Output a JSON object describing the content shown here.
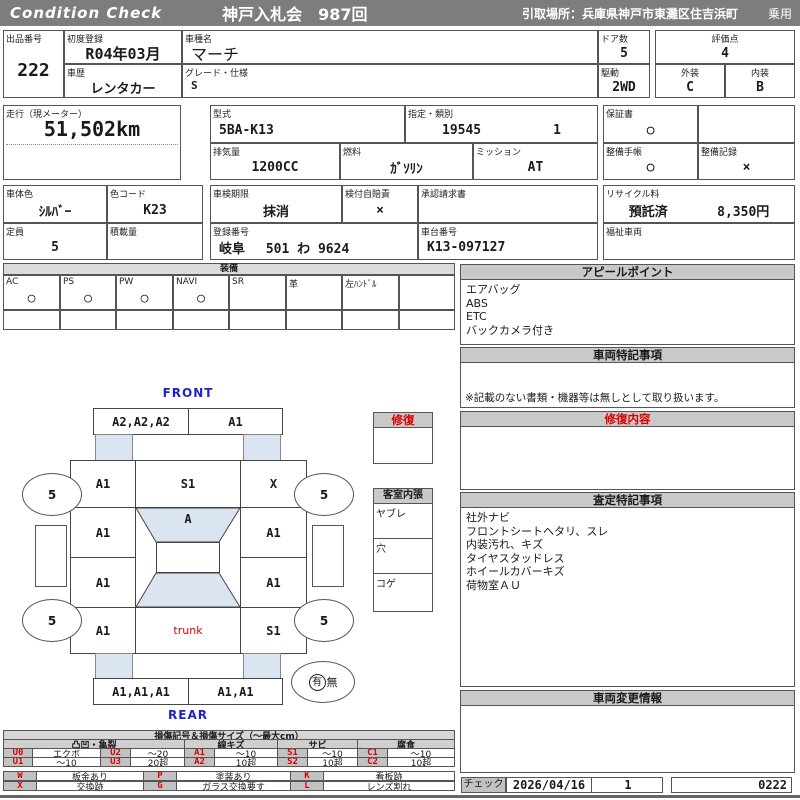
{
  "header": {
    "brand": "Condition  Check",
    "auction": "神戸入札会　987回",
    "pickup": "引取場所：兵庫県神戸市東灘区住吉浜町",
    "vehicle_type": "乗用"
  },
  "info": {
    "lot_label": "出品番号",
    "lot": "222",
    "first_reg_label": "初度登録",
    "first_reg": "R04年03月",
    "history_label": "車歴",
    "history": "レンタカー",
    "model_label": "車種名",
    "model": "マーチ",
    "grade_label": "グレード・仕様",
    "grade": "S",
    "doors_label": "ドア数",
    "doors": "5",
    "drive_label": "駆動",
    "drive": "2WD",
    "score_label": "評価点",
    "score": "4",
    "exterior_label": "外装",
    "exterior": "C",
    "interior_label": "内装",
    "interior": "B",
    "mileage_label": "走行（現メーター）",
    "mileage": "51,502km",
    "model_code_label": "型式",
    "model_code": "5BA-K13",
    "class_label": "指定・類別",
    "class_no": "19545",
    "class_no2": "1",
    "displacement_label": "排気量",
    "displacement": "1200CC",
    "fuel_label": "燃料",
    "fuel": "ｶﾞｿﾘﾝ",
    "mission_label": "ミッション",
    "mission": "AT",
    "warranty_label": "保証書",
    "warranty": "○",
    "maintenance_book_label": "整備手帳",
    "maintenance_book": "○",
    "maintenance_record_label": "整備記録",
    "maintenance_record": "×",
    "color_label": "車体色",
    "color": "ｼﾙﾊﾞｰ",
    "color_code_label": "色コード",
    "color_code": "K23",
    "capacity_label": "定員",
    "capacity": "5",
    "load_label": "積載量",
    "load": "",
    "inspection_label": "車検期限",
    "inspection": "抹消",
    "insurance_label": "検付自賠責",
    "insurance": "×",
    "approval_label": "承認請求書",
    "approval": "",
    "reg_no_label": "登録番号",
    "reg_no": "岐阜　 501 わ 9624",
    "chassis_label": "車台番号",
    "chassis": "K13-097127",
    "recycle_label": "リサイクル料",
    "recycle_status": "預託済",
    "recycle_fee": "8,350円",
    "welfare_label": "福祉車両",
    "welfare": ""
  },
  "equipment": {
    "title": "装備",
    "items": [
      {
        "label": "AC",
        "value": "○"
      },
      {
        "label": "PS",
        "value": "○"
      },
      {
        "label": "PW",
        "value": "○"
      },
      {
        "label": "NAVI",
        "value": "○"
      },
      {
        "label": "SR",
        "value": ""
      },
      {
        "label": "革",
        "value": ""
      },
      {
        "label": "左ﾊﾝﾄﾞﾙ",
        "value": ""
      },
      {
        "label": "",
        "value": ""
      }
    ]
  },
  "appeal": {
    "title": "アピールポイント",
    "lines": [
      "エアバッグ",
      "ABS",
      "ETC",
      "バックカメラ付き"
    ]
  },
  "vehicle_notes": {
    "title": "車両特記事項",
    "note": "※記載のない書類・機器等は無しとして取り扱います。"
  },
  "repair_details": {
    "title": "修復内容"
  },
  "assessment": {
    "title": "査定特記事項",
    "lines": [
      "社外ナビ",
      "フロントシートヘタリ、スレ",
      "内装汚れ、キズ",
      "タイヤスタッドレス",
      "ホイールカバーキズ",
      "荷物室ＡＵ"
    ]
  },
  "change_info": {
    "title": "車両変更情報"
  },
  "check": {
    "label": "チェック",
    "date": "2026/04/16",
    "count": "1",
    "code": "0222"
  },
  "diagram": {
    "front_label": "FRONT",
    "rear_label": "REAR",
    "front_bumper_left": "A2,A2,A2",
    "front_bumper_right": "A1",
    "left_front_fender": "A1",
    "hood": "S1",
    "right_front_fender": "X",
    "left_front_door": "A1",
    "windshield": "A",
    "right_front_door": "A1",
    "left_rear_door": "A1",
    "right_rear_door": "A1",
    "left_quarter": "A1",
    "trunk": "trunk",
    "right_quarter": "S1",
    "rear_bumper_left": "A1,A1,A1",
    "rear_bumper_right": "A1,A1",
    "tire_fl": "5",
    "tire_fr": "5",
    "tire_rl": "5",
    "tire_rr": "5",
    "spare": {
      "yes": "有",
      "no": "無"
    },
    "repair_box_label": "修復",
    "interior_box_label": "客室内張",
    "interior_rows": [
      "ヤブレ",
      "穴",
      "コゲ"
    ]
  },
  "legend": {
    "title": "損傷記号＆損傷サイズ（～最大cm）",
    "groups": [
      "凸凹・亀裂",
      "線キズ",
      "サビ",
      "腐食"
    ],
    "rows": [
      [
        "U0",
        "エクボ",
        "U2",
        "～20",
        "A1",
        "～10",
        "S1",
        "～10",
        "C1",
        "～10"
      ],
      [
        "U1",
        "～10",
        "U3",
        "20超",
        "A2",
        "10超",
        "S2",
        "10超",
        "C2",
        "10超"
      ]
    ],
    "marks": [
      [
        "W",
        "板金あり",
        "P",
        "塗装あり",
        "K",
        "看板跡"
      ],
      [
        "X",
        "交換跡",
        "G",
        "ガラス交換要す",
        "L",
        "レンズ割れ"
      ]
    ]
  },
  "colors": {
    "accent_red": "#dd0000",
    "accent_blue": "#2222cc",
    "glass_blue": "#dbe5f1",
    "bar_gray": "#7d7d7d"
  }
}
